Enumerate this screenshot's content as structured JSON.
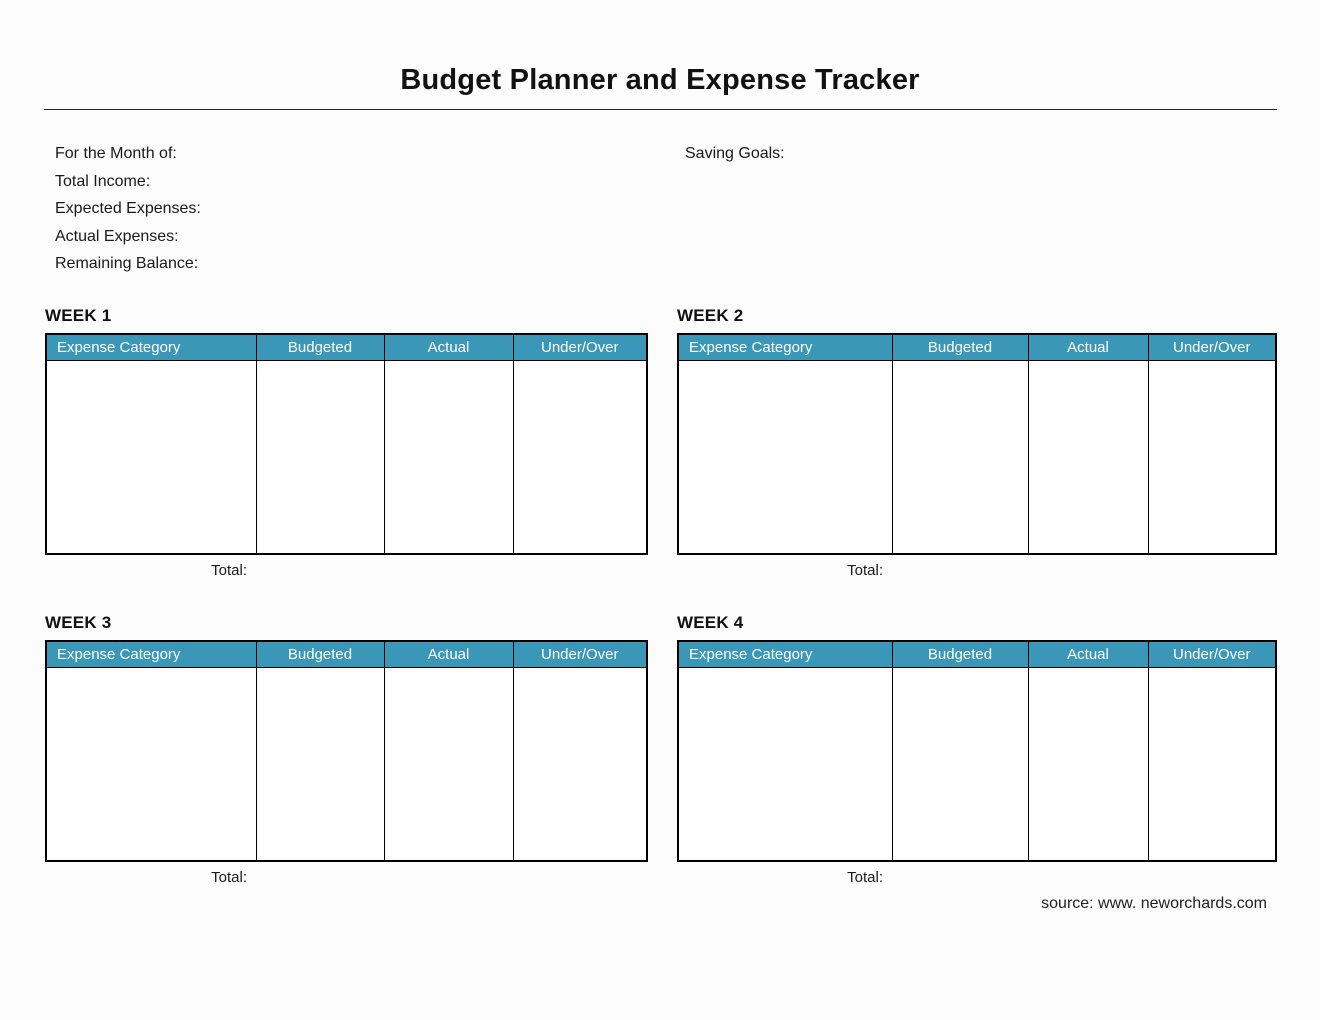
{
  "title": "Budget Planner and Expense Tracker",
  "summary": {
    "fields": [
      "For the Month of:",
      "Total Income:",
      "Expected Expenses:",
      "Actual Expenses:",
      "Remaining Balance:"
    ],
    "saving_goals_label": "Saving Goals:"
  },
  "table_columns": [
    "Expense Category",
    "Budgeted",
    "Actual",
    "Under/Over"
  ],
  "weeks": [
    {
      "heading": "WEEK 1",
      "total_label": "Total:"
    },
    {
      "heading": "WEEK 2",
      "total_label": "Total:"
    },
    {
      "heading": "WEEK 3",
      "total_label": "Total:"
    },
    {
      "heading": "WEEK 4",
      "total_label": "Total:"
    }
  ],
  "footer": {
    "source": "source: www. neworchards.com"
  },
  "colors": {
    "header_bg": "#3A97B8",
    "header_text": "#FFFFFF"
  }
}
